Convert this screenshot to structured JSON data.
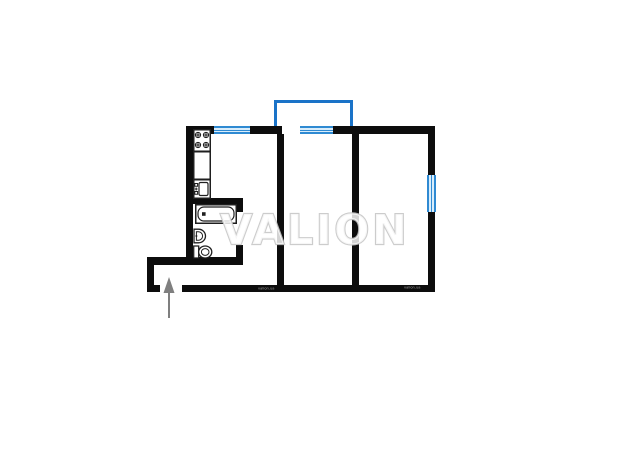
{
  "watermark": {
    "text": "VALION"
  },
  "wall_marks": {
    "left_text": "valion.ua",
    "right_text": "valion.ua"
  },
  "colors": {
    "background": "#ffffff",
    "wall": "#0d0d0d",
    "balcony": "#1a73c8",
    "window_border": "#2f8ad2",
    "window_fill": "#d9edfb",
    "arrow": "#7f7f7f",
    "fixture": "#1f1f1f",
    "watermark_outline": "#c6c6c6",
    "microtext": "#b3b3b3"
  },
  "icons": {
    "kitchen": [
      "stove-icon",
      "kitchen-counter-icon",
      "kitchen-sink-icon"
    ],
    "bathroom": [
      "bathtub-icon",
      "wash-basin-icon",
      "toilet-icon"
    ],
    "entrance": [
      "entrance-arrow-icon"
    ],
    "openings": [
      "kitchen-window-icon",
      "balcony-window-icon",
      "bedroom-window-icon",
      "balcony-outline"
    ]
  }
}
